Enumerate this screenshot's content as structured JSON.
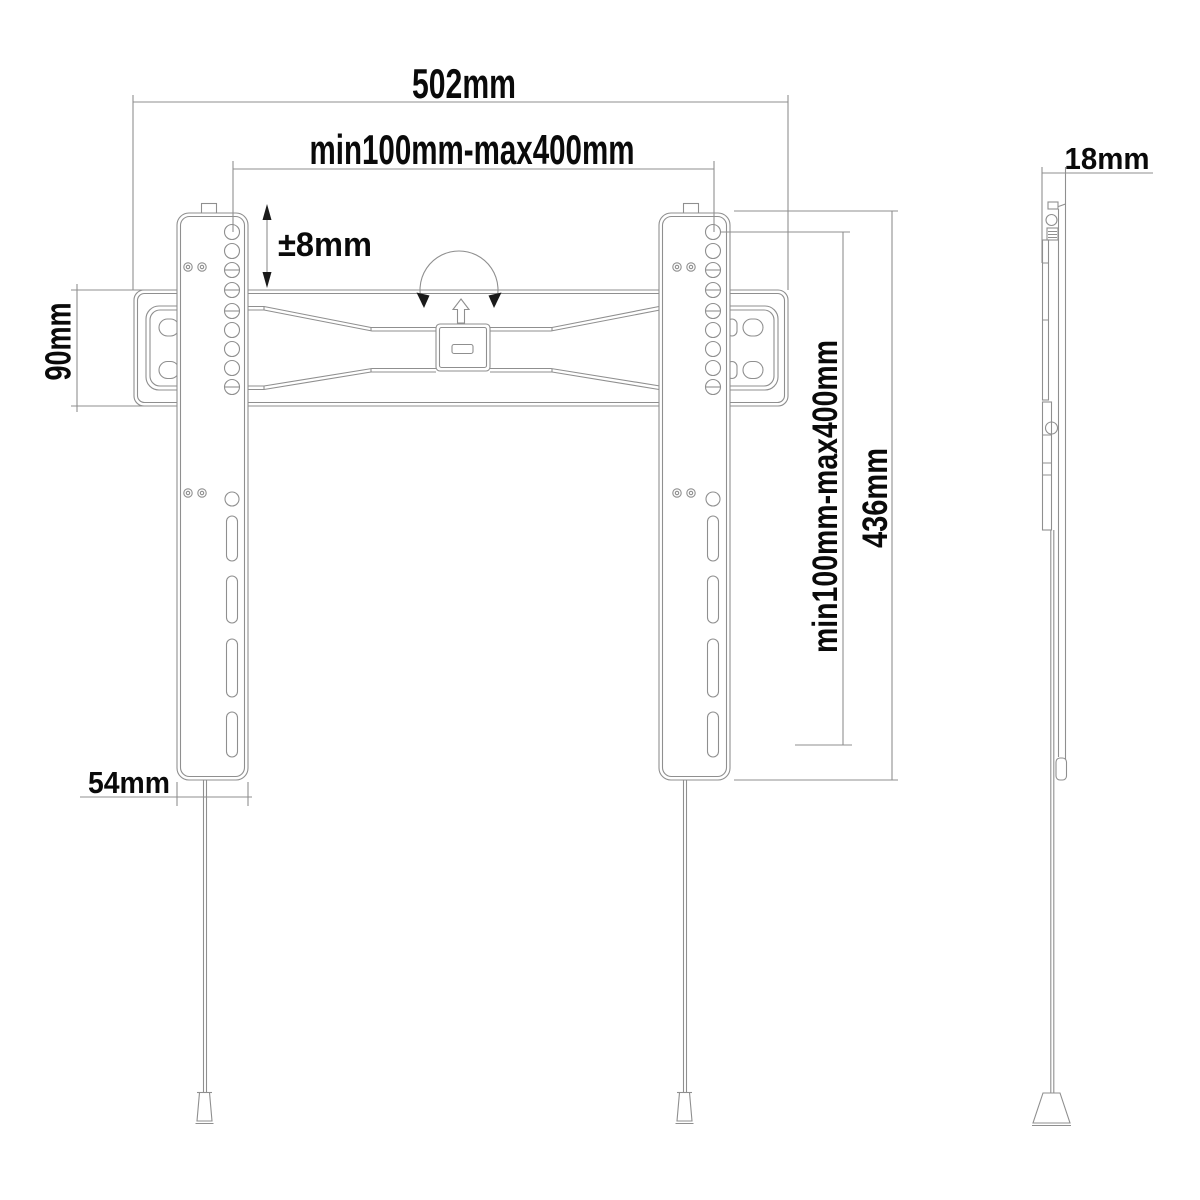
{
  "drawing": {
    "subject": "tv-wall-mount-technical-drawing",
    "labels": {
      "overall_width": "502mm",
      "vesa_width_range": "min100mm-max400mm",
      "vertical_adjustment": "±8mm",
      "wall_plate_height": "90mm",
      "vesa_height_range": "min100mm-max400mm",
      "bracket_height": "436mm",
      "rail_width": "54mm",
      "profile_depth": "18mm"
    },
    "colors": {
      "line": "#8f8f8f",
      "text": "#0a0a0a",
      "arrow": "#1a1a1a",
      "background": "#ffffff"
    }
  }
}
